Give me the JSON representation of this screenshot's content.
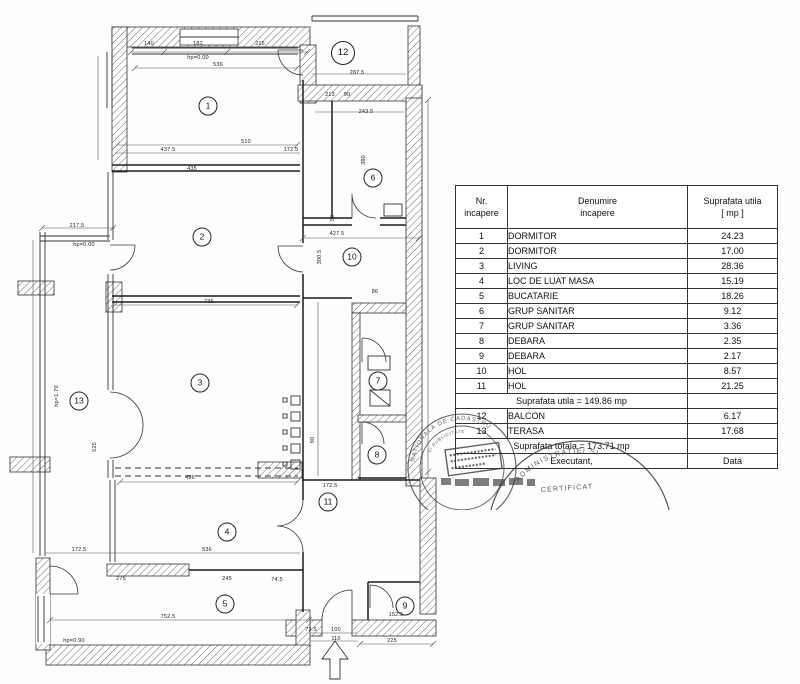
{
  "plan": {
    "room_markers": [
      {
        "n": "1",
        "x": 208,
        "y": 106
      },
      {
        "n": "2",
        "x": 202,
        "y": 237
      },
      {
        "n": "3",
        "x": 200,
        "y": 383
      },
      {
        "n": "4",
        "x": 227,
        "y": 532
      },
      {
        "n": "5",
        "x": 225,
        "y": 604
      },
      {
        "n": "6",
        "x": 373,
        "y": 178
      },
      {
        "n": "7",
        "x": 378,
        "y": 381
      },
      {
        "n": "8",
        "x": 377,
        "y": 455
      },
      {
        "n": "9",
        "x": 405,
        "y": 606
      },
      {
        "n": "10",
        "x": 352,
        "y": 257
      },
      {
        "n": "11",
        "x": 328,
        "y": 502
      },
      {
        "n": "12",
        "x": 343,
        "y": 53
      },
      {
        "n": "13",
        "x": 79,
        "y": 401
      }
    ],
    "dimension_labels": [
      {
        "t": "140",
        "x": 149,
        "y": 44
      },
      {
        "t": "182",
        "x": 198,
        "y": 44
      },
      {
        "t": "215",
        "x": 260,
        "y": 44
      },
      {
        "t": "hp=0.00",
        "x": 198,
        "y": 58
      },
      {
        "t": "536",
        "x": 218,
        "y": 65
      },
      {
        "t": "287.5",
        "x": 357,
        "y": 73
      },
      {
        "t": "243.5",
        "x": 366,
        "y": 112
      },
      {
        "t": "510",
        "x": 246,
        "y": 142
      },
      {
        "t": "437.5",
        "x": 168,
        "y": 150
      },
      {
        "t": "172.5",
        "x": 291,
        "y": 150
      },
      {
        "t": "435",
        "x": 192,
        "y": 169
      },
      {
        "t": "213",
        "x": 330,
        "y": 95
      },
      {
        "t": "90",
        "x": 347,
        "y": 95
      },
      {
        "t": "427.5",
        "x": 337,
        "y": 234
      },
      {
        "t": "217.5",
        "x": 77,
        "y": 226
      },
      {
        "t": "hp=0.00",
        "x": 84,
        "y": 245
      },
      {
        "t": "736",
        "x": 209,
        "y": 302
      },
      {
        "t": "525",
        "x": 95,
        "y": 447,
        "r": 1
      },
      {
        "t": "hp=1.70",
        "x": 57,
        "y": 396,
        "r": 1
      },
      {
        "t": "380",
        "x": 364,
        "y": 160,
        "r": 1
      },
      {
        "t": "300.5",
        "x": 320,
        "y": 257,
        "r": 1
      },
      {
        "t": "56",
        "x": 333,
        "y": 218,
        "r": 1
      },
      {
        "t": "86",
        "x": 375,
        "y": 292
      },
      {
        "t": "496",
        "x": 190,
        "y": 478
      },
      {
        "t": "172.5",
        "x": 330,
        "y": 486
      },
      {
        "t": "90",
        "x": 313,
        "y": 440,
        "r": 1
      },
      {
        "t": "172.5",
        "x": 79,
        "y": 550
      },
      {
        "t": "536",
        "x": 207,
        "y": 550
      },
      {
        "t": "275",
        "x": 121,
        "y": 579
      },
      {
        "t": "245",
        "x": 227,
        "y": 579
      },
      {
        "t": "74.5",
        "x": 277,
        "y": 580
      },
      {
        "t": "752.5",
        "x": 168,
        "y": 617
      },
      {
        "t": "hp=0.90",
        "x": 74,
        "y": 641
      },
      {
        "t": "73.5",
        "x": 311,
        "y": 630
      },
      {
        "t": "100",
        "x": 336,
        "y": 630
      },
      {
        "t": "110",
        "x": 336,
        "y": 639
      },
      {
        "t": "225",
        "x": 392,
        "y": 641
      },
      {
        "t": "152.5",
        "x": 396,
        "y": 615
      }
    ]
  },
  "table": {
    "headers": [
      "Nr.\nincapere",
      "Denumire\nincapere",
      "Suprafata utila\n[ mp ]"
    ],
    "rows": [
      {
        "nr": "1",
        "name": "DORMITOR",
        "area": "24.23"
      },
      {
        "nr": "2",
        "name": "DORMITOR",
        "area": "17.00"
      },
      {
        "nr": "3",
        "name": "LIVING",
        "area": "28.36"
      },
      {
        "nr": "4",
        "name": "LOC DE LUAT MASA",
        "area": "15.19"
      },
      {
        "nr": "5",
        "name": "BUCATARIE",
        "area": "18.26"
      },
      {
        "nr": "6",
        "name": "GRUP SANITAR",
        "area": "9.12"
      },
      {
        "nr": "7",
        "name": "GRUP SANITAR",
        "area": "3.36"
      },
      {
        "nr": "8",
        "name": "DEBARA",
        "area": "2.35"
      },
      {
        "nr": "9",
        "name": "DEBARA",
        "area": "2.17"
      },
      {
        "nr": "10",
        "name": "HOL",
        "area": "8.57"
      },
      {
        "nr": "11",
        "name": "HOL",
        "area": "21.25"
      }
    ],
    "subtotal_label": "Suprafata utila = 149.86 mp",
    "rows_annex": [
      {
        "nr": "12",
        "name": "BALCON",
        "area": "6.17"
      },
      {
        "nr": "13",
        "name": "TERASA",
        "area": "17.68"
      }
    ],
    "total_label": "Suprafata totala = 173.71 mp",
    "executant_label": "Executant,",
    "data_label": "Data"
  },
  "stamps": {
    "round_left_outer": "NATIONALA DE CADASTRU",
    "round_left_inner": "SI PUBLICITATE",
    "round_right_arc": "ADMINISTRATIEI SI",
    "round_right_word": "CERTIFICAT"
  }
}
